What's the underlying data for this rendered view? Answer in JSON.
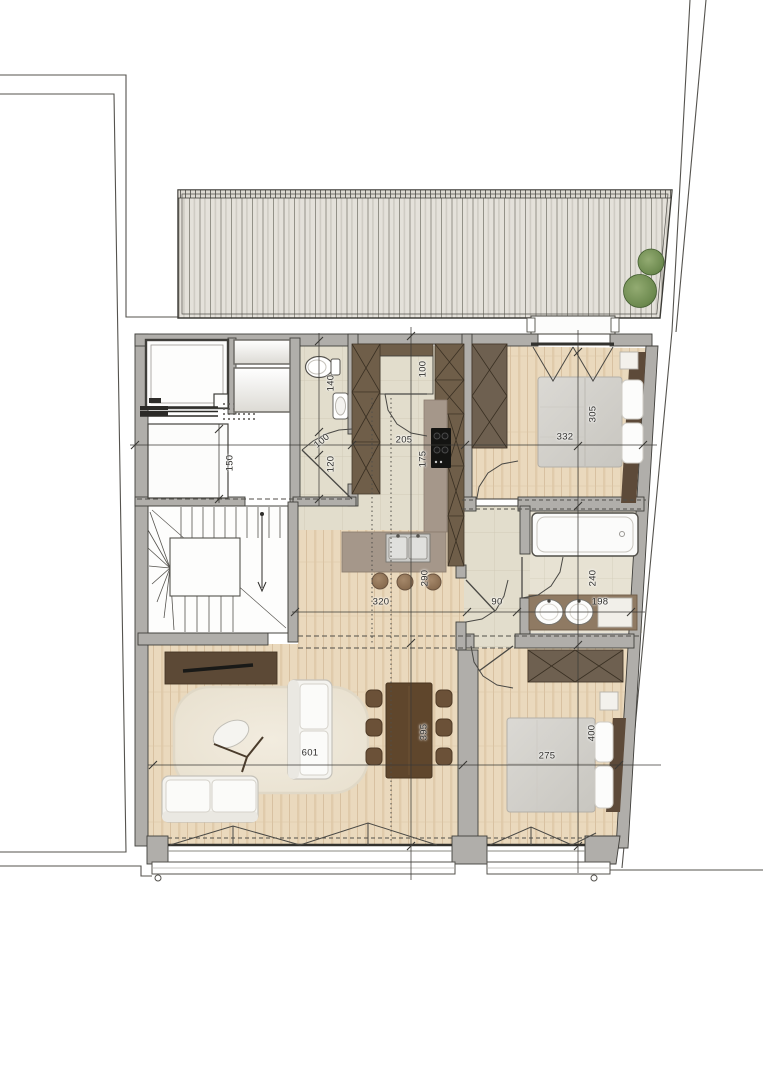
{
  "document": {
    "kind": "architectural floor plan, top-down view",
    "areas": [
      "terrace-deck",
      "storage-void",
      "laundry",
      "wc",
      "stair-hall",
      "kitchen-corridor",
      "bedroom-1",
      "bathroom",
      "hallway",
      "living-dining",
      "bedroom-2"
    ],
    "palette": {
      "wood_floor": "#ead9bd",
      "stone_floor": "#e2ddcc",
      "deck": "#e4e1da",
      "cabinetry_brown": "#6f5e49",
      "counter_taupe": "#a5978a",
      "wall_gray": "#b0aeaa",
      "line_dark": "#3f3e3a",
      "bush_green": "#6d8a4f",
      "duvet_gray": "#d6d4cf"
    },
    "icons": [
      "toilet-icon",
      "sink-icon",
      "bathtub-icon",
      "double-sink-vanity-icon",
      "cooktop-icon",
      "kitchen-island-sink-icon",
      "bed-icon",
      "wardrobe-icon",
      "sofa-icon",
      "rug-icon",
      "lounge-chair-icon",
      "dining-table-icon",
      "stair-icon",
      "bush-icon",
      "folding-door-icon",
      "door-swing-icon",
      "tv-sideboard-icon"
    ]
  },
  "dimensions": [
    {
      "value": "140",
      "orientation": "vertical"
    },
    {
      "value": "100",
      "orientation": "tilted"
    },
    {
      "value": "120",
      "orientation": "vertical"
    },
    {
      "value": "150",
      "orientation": "vertical"
    },
    {
      "value": "100",
      "orientation": "vertical"
    },
    {
      "value": "205",
      "orientation": "horizontal"
    },
    {
      "value": "175",
      "orientation": "vertical"
    },
    {
      "value": "290",
      "orientation": "vertical"
    },
    {
      "value": "320",
      "orientation": "horizontal"
    },
    {
      "value": "90",
      "orientation": "horizontal"
    },
    {
      "value": "198",
      "orientation": "horizontal"
    },
    {
      "value": "240",
      "orientation": "vertical"
    },
    {
      "value": "332",
      "orientation": "horizontal"
    },
    {
      "value": "305",
      "orientation": "vertical"
    },
    {
      "value": "601",
      "orientation": "horizontal"
    },
    {
      "value": "395",
      "orientation": "vertical"
    },
    {
      "value": "275",
      "orientation": "horizontal"
    },
    {
      "value": "400",
      "orientation": "vertical"
    }
  ]
}
